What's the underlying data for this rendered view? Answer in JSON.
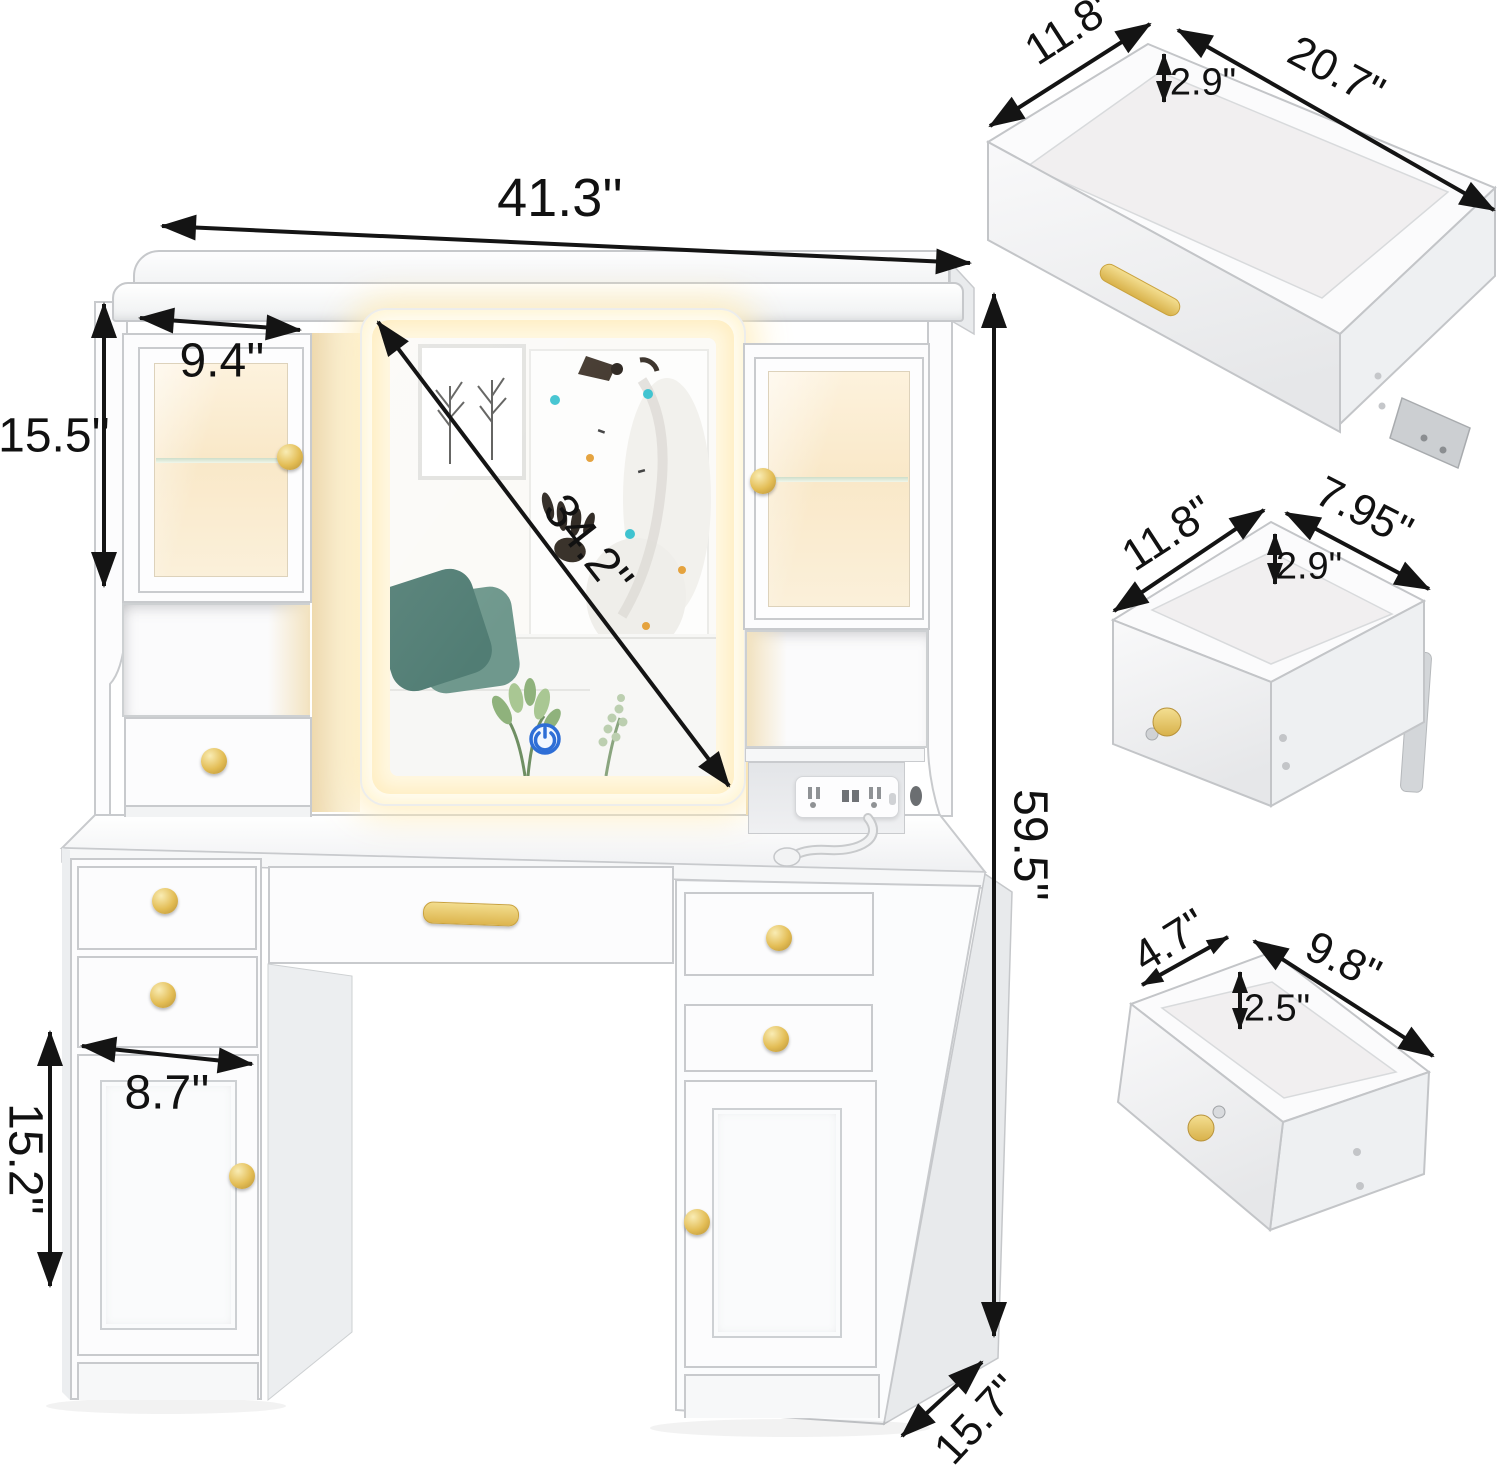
{
  "diagram": {
    "title": "vanity-desk-dimension-diagram",
    "main": {
      "overall_width": "41.3''",
      "overall_height": "59.5''",
      "overall_depth": "15.7''",
      "mirror_diagonal": "34.2''",
      "upper_cabinet_width": "9.4''",
      "upper_cabinet_height": "15.5''",
      "lower_cabinet_width": "8.7''",
      "lower_cabinet_height": "15.2''"
    },
    "drawer_details": [
      {
        "name": "large-top-drawer",
        "depth_label": "11.8\"",
        "width_label": "20.7\"",
        "height_label": "2.9\""
      },
      {
        "name": "middle-side-drawer",
        "depth_label": "11.8\"",
        "width_label": "7.95\"",
        "height_label": "2.9\""
      },
      {
        "name": "small-hutch-drawer",
        "depth_label": "4.7\"",
        "width_label": "9.8\"",
        "height_label": "2.5\""
      }
    ],
    "colors": {
      "accent_gold": "#ddb54e",
      "led_glow": "#ffedc0",
      "arrow": "#141414",
      "teal_pillow": "#517d74",
      "power_icon_blue": "#2e6ed6"
    }
  }
}
